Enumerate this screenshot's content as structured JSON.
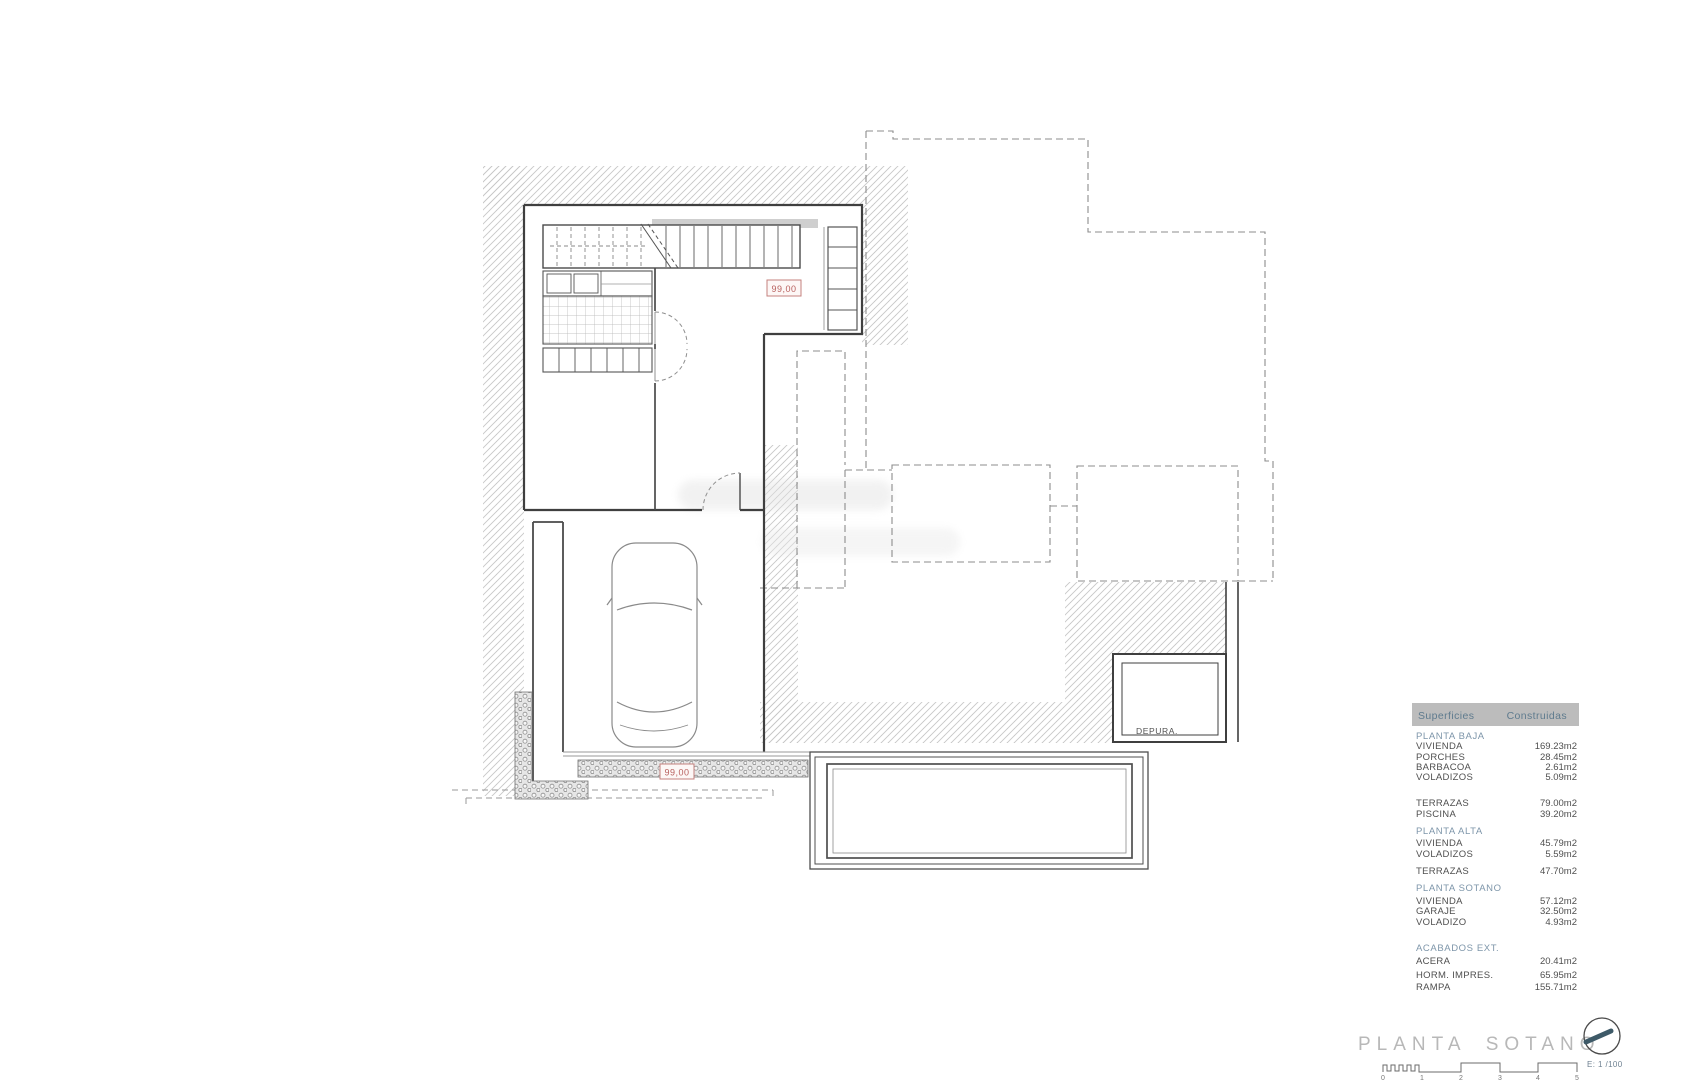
{
  "plan": {
    "level_labels": {
      "upper": "99,00",
      "lower": "99,00"
    },
    "rooms": {
      "depura": "DEPURA."
    }
  },
  "table": {
    "header": {
      "col1": "Superficies",
      "col2": "Construidas"
    },
    "rows": [
      {
        "label": "PLANTA BAJA",
        "value": "",
        "type": "section"
      },
      {
        "label": "VIVIENDA",
        "value": "169.23m2",
        "type": "row"
      },
      {
        "label": "PORCHES",
        "value": "28.45m2",
        "type": "row"
      },
      {
        "label": "BARBACOA",
        "value": "2.61m2",
        "type": "row"
      },
      {
        "label": "VOLADIZOS",
        "value": "5.09m2",
        "type": "row"
      },
      {
        "label": "TERRAZAS",
        "value": "79.00m2",
        "type": "row"
      },
      {
        "label": "PISCINA",
        "value": "39.20m2",
        "type": "row"
      },
      {
        "label": "PLANTA ALTA",
        "value": "",
        "type": "section"
      },
      {
        "label": "VIVIENDA",
        "value": "45.79m2",
        "type": "row"
      },
      {
        "label": "VOLADIZOS",
        "value": "5.59m2",
        "type": "row"
      },
      {
        "label": "TERRAZAS",
        "value": "47.70m2",
        "type": "row"
      },
      {
        "label": "PLANTA SOTANO",
        "value": "",
        "type": "section"
      },
      {
        "label": "VIVIENDA",
        "value": "57.12m2",
        "type": "row"
      },
      {
        "label": "GARAJE",
        "value": "32.50m2",
        "type": "row"
      },
      {
        "label": "VOLADIZO",
        "value": "4.93m2",
        "type": "row"
      },
      {
        "label": "ACABADOS EXT.",
        "value": "",
        "type": "section"
      },
      {
        "label": "ACERA",
        "value": "20.41m2",
        "type": "row"
      },
      {
        "label": "HORM. IMPRES.",
        "value": "65.95m2",
        "type": "row"
      },
      {
        "label": "RAMPA",
        "value": "155.71m2",
        "type": "row"
      }
    ]
  },
  "footer": {
    "title": "PLANTA SOTANO",
    "scale_label": "E: 1 /100",
    "ticks": [
      "0",
      "1",
      "2",
      "3",
      "4",
      "5"
    ]
  },
  "colors": {
    "accent_red": "#b8605e",
    "section_blue": "#7e96aa",
    "header_bar_gray": "#bcbcbc",
    "title_gray": "#b8b8b8",
    "wall_dark": "#3f3f3f"
  }
}
